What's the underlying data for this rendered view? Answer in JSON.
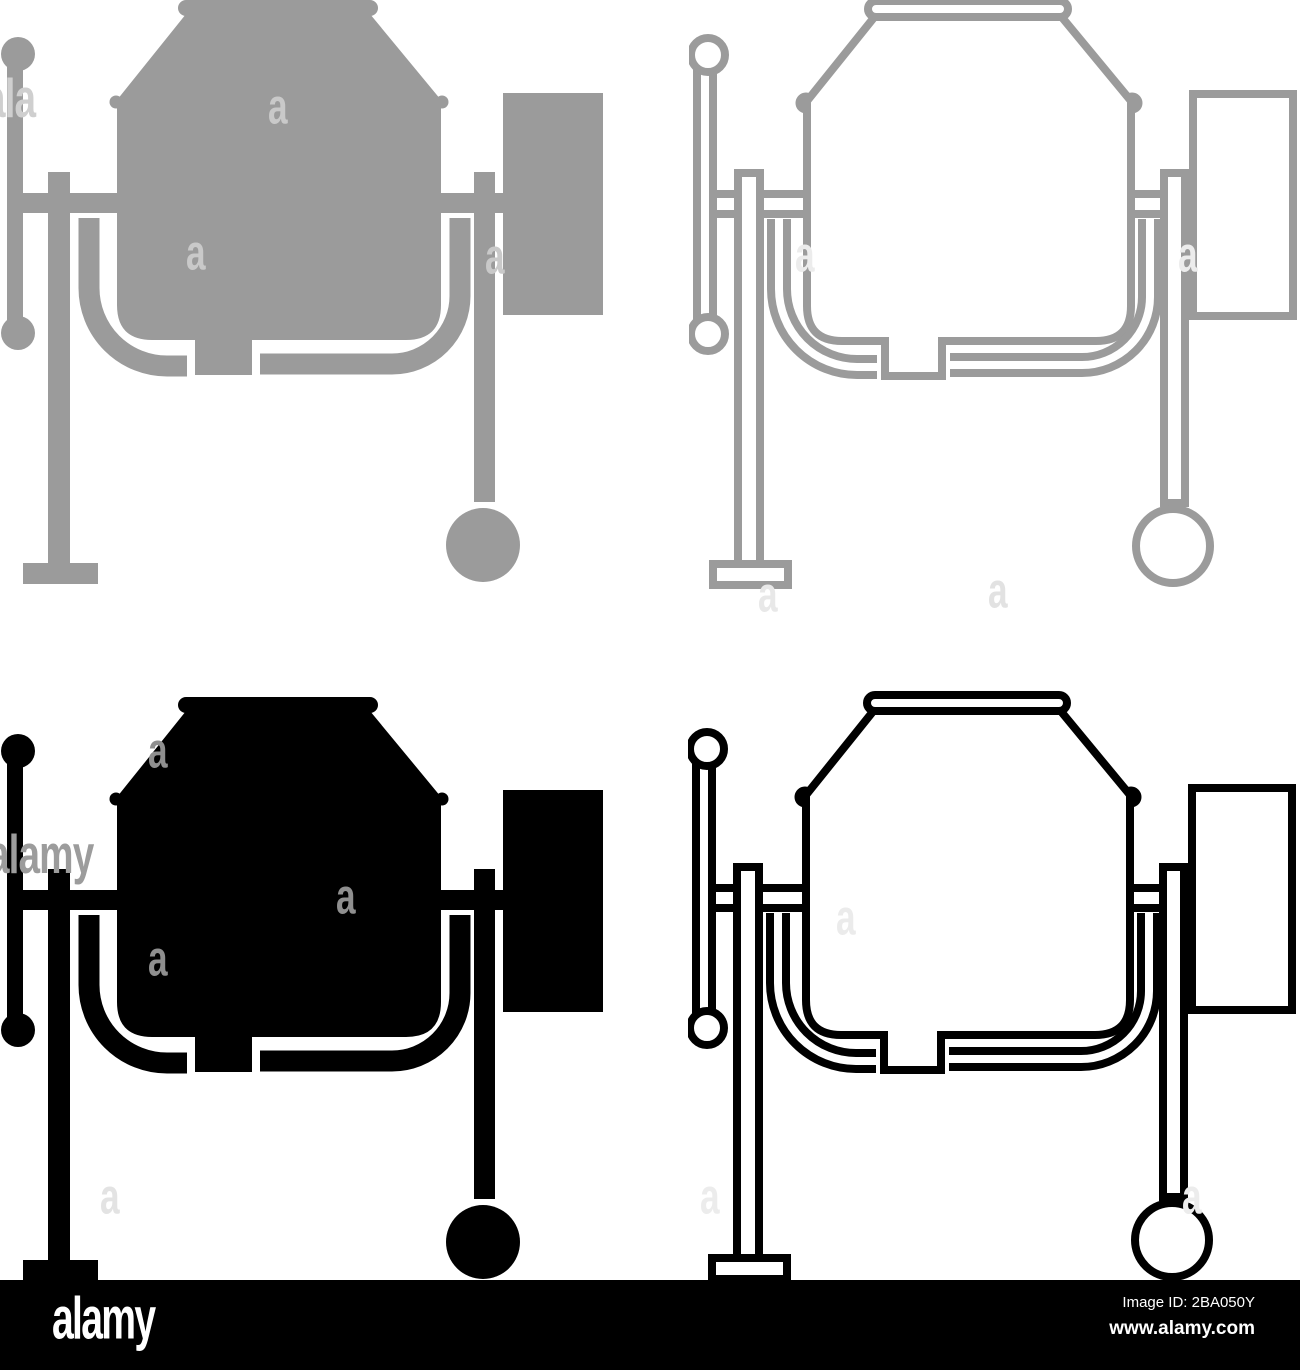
{
  "page": {
    "width": 1300,
    "height": 1370,
    "background": "#ffffff"
  },
  "icons": {
    "variants": [
      {
        "label": "concrete mixer grey filled",
        "style": "filled",
        "color": "#9b9b9b",
        "x": 3,
        "y": 0
      },
      {
        "label": "concrete mixer grey outline",
        "style": "outline",
        "color": "#9b9b9b",
        "x": 693,
        "y": 1
      },
      {
        "label": "concrete mixer black filled",
        "style": "filled",
        "color": "#000000",
        "x": 3,
        "y": 697
      },
      {
        "label": "concrete mixer black outline",
        "style": "outline",
        "color": "#000000",
        "x": 692,
        "y": 695
      }
    ]
  },
  "watermarks": {
    "items": [
      {
        "text": "ala",
        "x": -16,
        "y": 72,
        "size": 44,
        "color": "#cfcfcf"
      },
      {
        "text": "a",
        "x": 268,
        "y": 82,
        "size": 40,
        "color": "#c9c9c9"
      },
      {
        "text": "a",
        "x": 186,
        "y": 228,
        "size": 40,
        "color": "#c9c9c9"
      },
      {
        "text": "a",
        "x": 485,
        "y": 232,
        "size": 40,
        "color": "#c9c9c9"
      },
      {
        "text": "a",
        "x": 795,
        "y": 230,
        "size": 40,
        "color": "#ececec"
      },
      {
        "text": "a",
        "x": 1178,
        "y": 230,
        "size": 40,
        "color": "#ececec"
      },
      {
        "text": "a",
        "x": 758,
        "y": 570,
        "size": 40,
        "color": "#e8e8e8"
      },
      {
        "text": "a",
        "x": 988,
        "y": 566,
        "size": 40,
        "color": "#e2e2e2"
      },
      {
        "text": "a",
        "x": 148,
        "y": 726,
        "size": 40,
        "color": "#8f8f8f"
      },
      {
        "text": "alamy",
        "x": -12,
        "y": 828,
        "size": 44,
        "color": "#9c9c9c"
      },
      {
        "text": "a",
        "x": 336,
        "y": 872,
        "size": 40,
        "color": "#8f8f8f"
      },
      {
        "text": "a",
        "x": 148,
        "y": 934,
        "size": 40,
        "color": "#8f8f8f"
      },
      {
        "text": "a",
        "x": 100,
        "y": 1172,
        "size": 40,
        "color": "#e3e3e3"
      },
      {
        "text": "a",
        "x": 836,
        "y": 893,
        "size": 40,
        "color": "#ebebeb"
      },
      {
        "text": "a",
        "x": 700,
        "y": 1172,
        "size": 40,
        "color": "#ececec"
      },
      {
        "text": "a",
        "x": 1182,
        "y": 1172,
        "size": 40,
        "color": "#ececec"
      }
    ]
  },
  "footer": {
    "logo": "alamy",
    "image_id": "Image ID: 2BA050Y",
    "website": "www.alamy.com",
    "background": "#000000",
    "text_color": "#ffffff"
  }
}
